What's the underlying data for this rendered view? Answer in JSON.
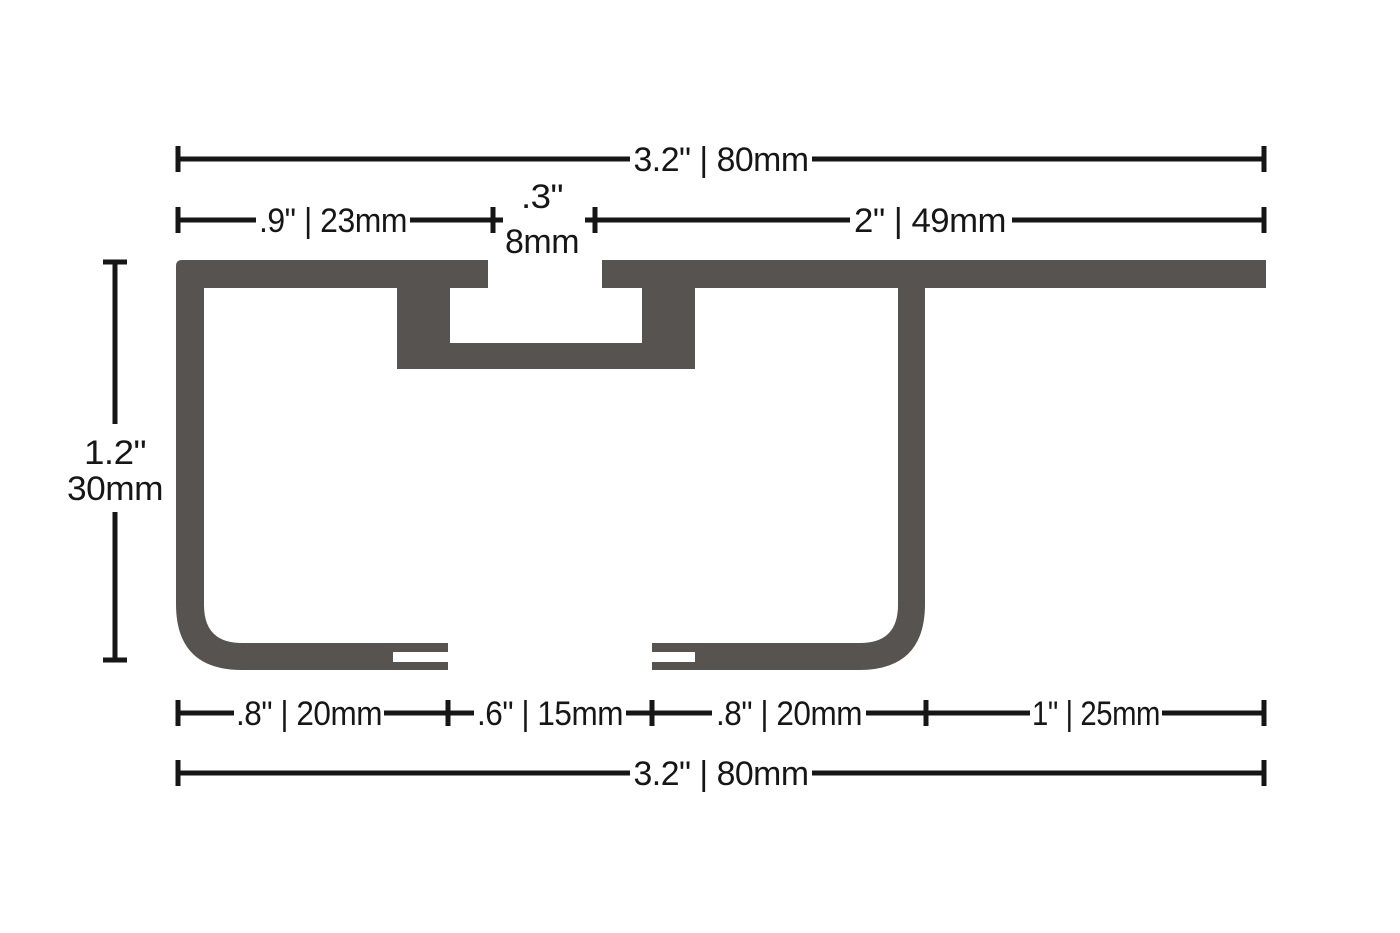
{
  "diagram": {
    "type": "technical-cross-section",
    "description": "Extruded track profile cross section with imperial and metric dimensions",
    "dims": {
      "top_total": "3.2\" | 80mm",
      "top_left_segment": ".9\" | 23mm",
      "slot_inches": ".3\"",
      "slot_mm": "8mm",
      "top_right_segment": "2\" | 49mm",
      "height_inches": "1.2\"",
      "height_mm": "30mm",
      "bottom_segment_1": ".8\" | 20mm",
      "bottom_segment_2": ".6\" | 15mm",
      "bottom_segment_3": ".8\" | 20mm",
      "bottom_segment_4": "1\" | 25mm",
      "bottom_total": "3.2\" | 80mm"
    },
    "colors": {
      "profile": "#575350",
      "annotation": "#161616",
      "background": "#ffffff"
    }
  }
}
